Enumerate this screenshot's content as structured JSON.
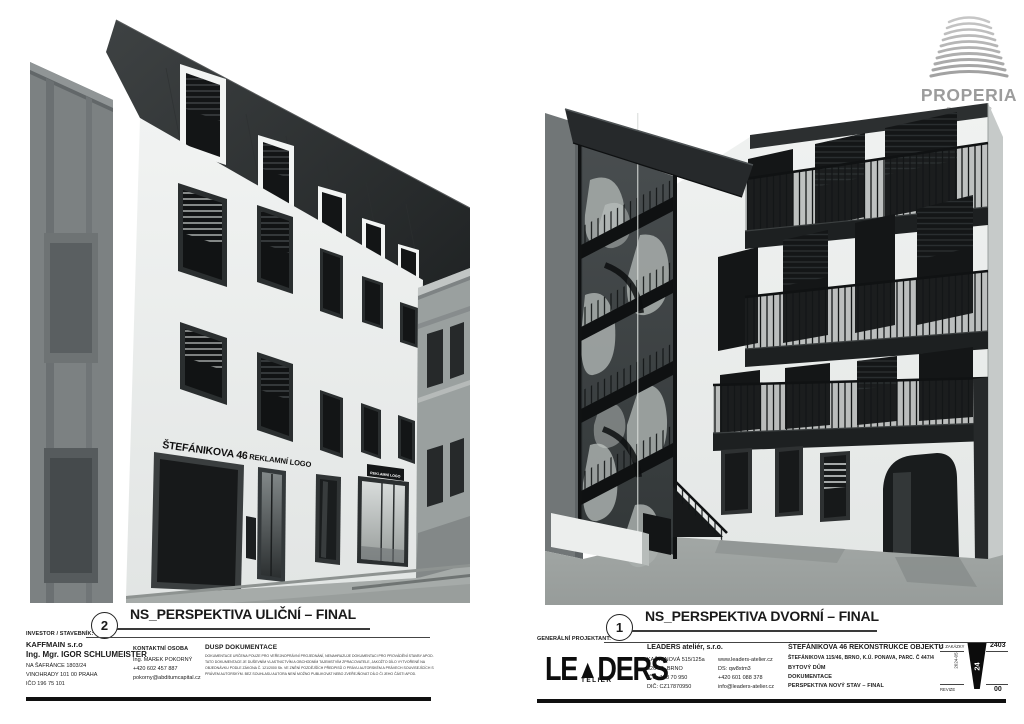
{
  "brand": {
    "name": "PROPERIA",
    "group": "GROUP"
  },
  "drawings": {
    "street": {
      "number": "2",
      "title": "NS_PERSPEKTIVA ULIČNÍ – FINAL",
      "label_address": "ŠTEFÁNIKOVA 46",
      "label_logo": "REKLAMNÍ LOGO",
      "label_logo_small": "REKLAMNÍ LOGO"
    },
    "courtyard": {
      "number": "1",
      "title": "NS_PERSPEKTIVA DVORNÍ – FINAL"
    }
  },
  "titleblock": {
    "investor": {
      "heading": "INVESTOR / STAVEBNÍK:",
      "company": "KAFFMAIN s.r.o",
      "name": "Ing. Mgr. IGOR SCHLUMEISTER",
      "address1": "NA ŠAFRÁNCE 1803/24",
      "address2": "VINOHRADY 101 00 PRAHA",
      "ico": "IČO 196 75 101"
    },
    "contact": {
      "heading": "KONTAKTNÍ OSOBA",
      "name": "Ing. MAREK POKORNÝ",
      "phone": "+420 602 457 887",
      "email": "pokorny@abditumcapital.cz"
    },
    "dusp": {
      "heading": "DUSP DOKUMENTACE",
      "line1": "DOKUMENTACE URČENA POUZE PRO VEŘEJNOPRÁVNÍ PROJEDNÁNÍ, NENAHRAZUJE DOKUMENTACI PRO PROVÁDĚNÍ STAVBY APOD.",
      "line2": "TATO DOKUMENTACE JE DUŠEVNÍM VLASTNICTVÍM A OBCHODNÍM TAJEMSTVÍM ZPRACOVATELE, JAKOŽTO DÍLO VYTVOŘENÉ NA",
      "line3": "OBJEDNÁVKU PODLE ZÁKONA Č. 121/2000 Sb. VE ZNĚNÍ POZDĚJŠÍCH PŘEDPISŮ O PRÁVU AUTORSKÉM A PRÁVECH SOUVISEJÍCÍCH S",
      "line4": "PRÁVEM AUTORSKÝM. BEZ SOUHLASU AUTORA NENÍ MOŽNO PUBLIKOVAT NEBO ZVEŘEJŇOVAT DÍLO ČI JEHO ČÁSTI APOD."
    },
    "projektant": {
      "heading": "GENERÁLNÍ PROJEKTANT:",
      "logo_l1": "LE",
      "logo_tri": "▲",
      "logo_l2": "DERS",
      "logo_sub": "TELIÉR",
      "company": "LEADERS ateliér, s.r.o.",
      "address1": "KAŠTANOVÁ 515/125a",
      "address2": "620 00, BRNO",
      "ico": "IČO: 178 70 950",
      "dic": "DIČ: CZ17870950",
      "web": "www.leaders-atelier.cz",
      "ds": "DS: qw8xtm3",
      "phone": "+420 601 088 378",
      "email": "info@leaders-atelier.cz"
    },
    "project": {
      "title": "ŠTEFÁNIKOVA 46 REKONSTRUKCE OBJEKTU",
      "subtitle": "ŠTEFÁNIKOVA 115/46, BRNO, K.Ú. PONAVA, PARC. Č 447/4",
      "line3": "BYTOVÝ DŮM",
      "line4": "DOKUMENTACE",
      "line5": "PERSPEKTIVA NOVÝ STAV – FINAL"
    },
    "revision": {
      "order_label": "Č. ZAKÁZKY",
      "order_no": "2403",
      "rev_label": "REVIZE",
      "rev_no": "00",
      "date": "2024-05",
      "mark": "24"
    }
  },
  "colors": {
    "roof_dark": "#26292a",
    "facade_white": "#edefee",
    "neighbor_gray": "#7c8182",
    "street_gray": "#a6aba9",
    "steel_black": "#121415",
    "logo_gray": "#9c9c9c"
  }
}
